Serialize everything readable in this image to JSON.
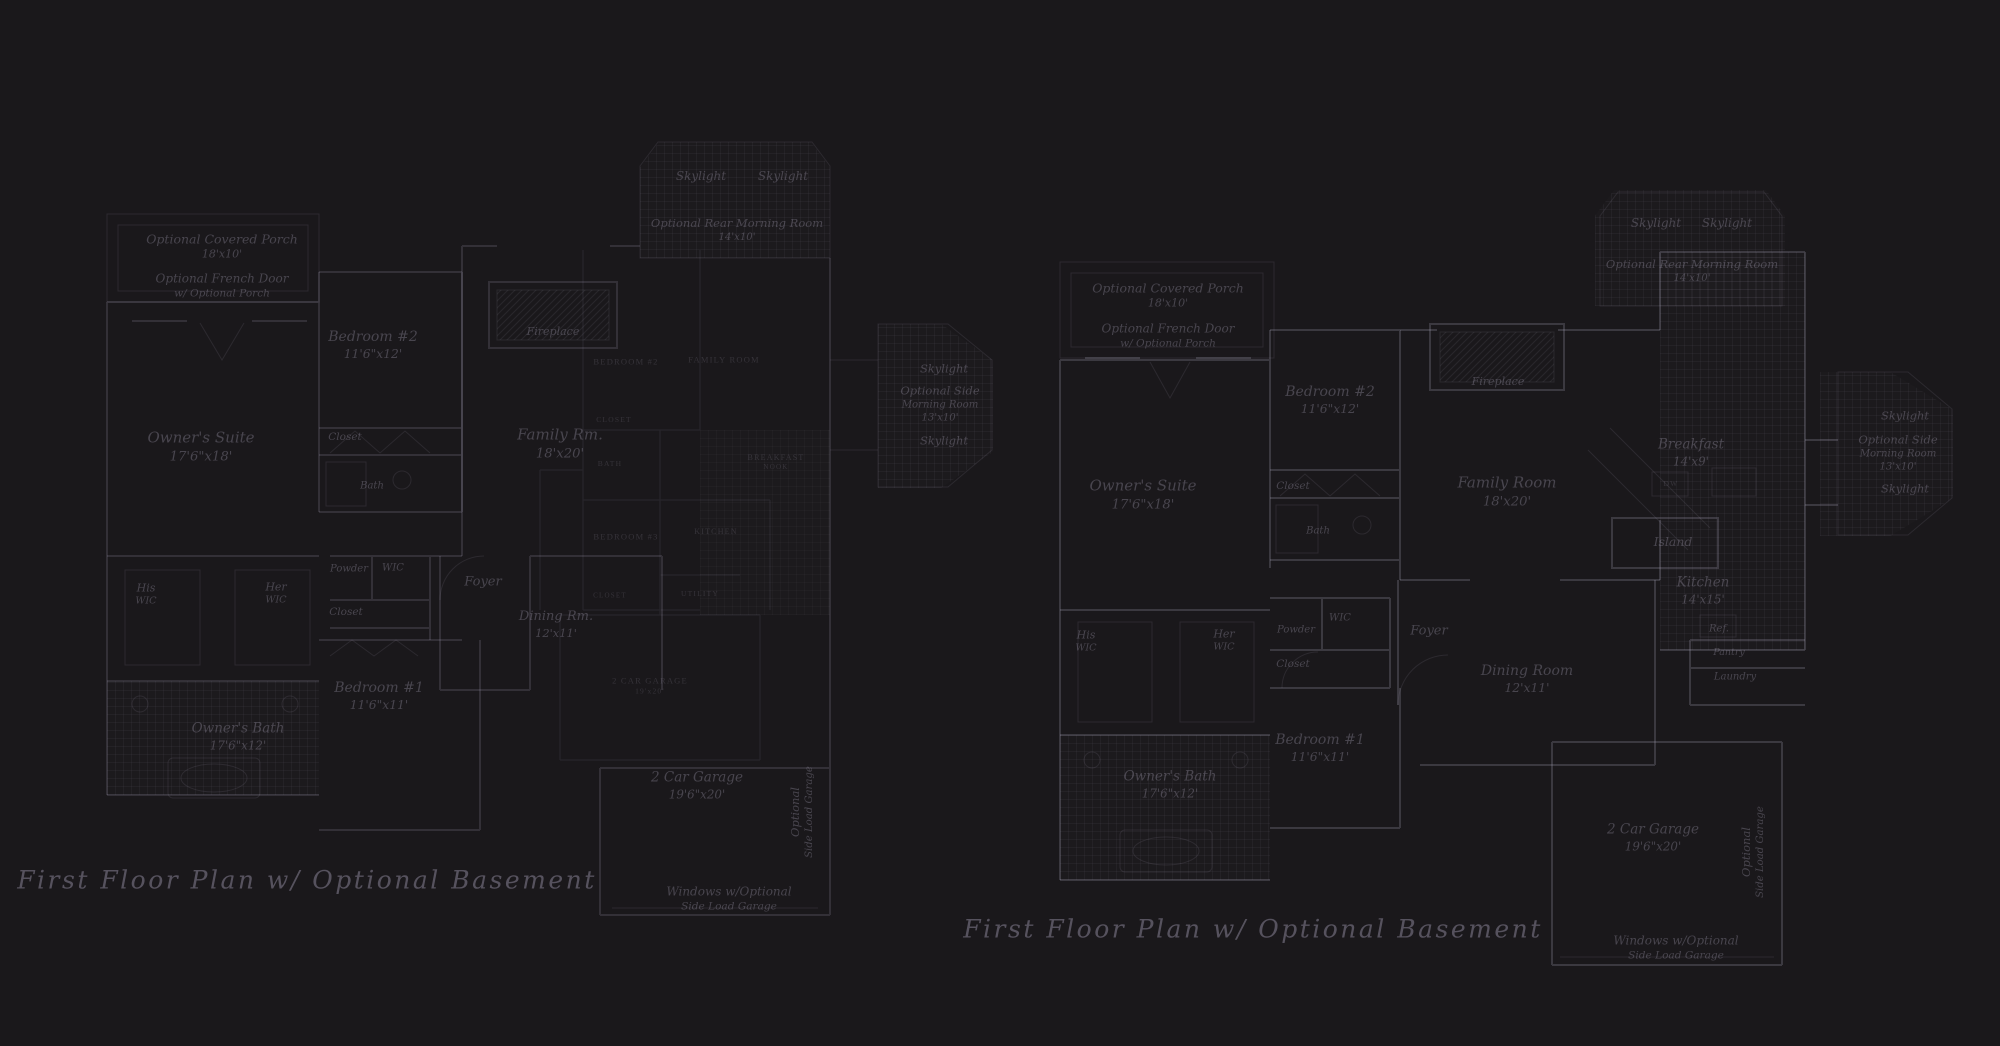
{
  "colors": {
    "background": "#1a181b",
    "wall_line": "#3b3843",
    "room_label_text": "#575263",
    "caption_text": "#5c5668"
  },
  "plans": [
    {
      "id": "left",
      "caption": "First Floor Plan  w/ Optional Basement",
      "caption_x": 307,
      "caption_y": 880,
      "labels": [
        {
          "name": "covered-porch-label",
          "x": 222,
          "y": 247,
          "size": 12.5,
          "lines": [
            "Optional Covered Porch",
            "18'x10'"
          ]
        },
        {
          "name": "french-door-label",
          "x": 222,
          "y": 286,
          "size": 12,
          "lines": [
            "Optional French Door",
            "w/ Optional Porch"
          ]
        },
        {
          "name": "skylight-rear-label-a",
          "x": 701,
          "y": 177,
          "size": 12,
          "lines": [
            "Skylight"
          ]
        },
        {
          "name": "skylight-rear-label-b",
          "x": 783,
          "y": 177,
          "size": 12,
          "lines": [
            "Skylight"
          ]
        },
        {
          "name": "rear-morning-room-label",
          "x": 737,
          "y": 230,
          "size": 11.5,
          "lines": [
            "Optional Rear Morning Room",
            "14'x10'"
          ]
        },
        {
          "name": "bedroom2-label",
          "x": 373,
          "y": 345,
          "size": 14,
          "lines": [
            "Bedroom #2",
            "11'6\"x12'"
          ]
        },
        {
          "name": "owners-suite-label",
          "x": 201,
          "y": 447,
          "size": 15,
          "lines": [
            "Owner's Suite",
            "17'6\"x18'"
          ]
        },
        {
          "name": "closet-bedroom2-label",
          "x": 345,
          "y": 438,
          "size": 10.5,
          "lines": [
            "Closet"
          ]
        },
        {
          "name": "bath-label",
          "x": 372,
          "y": 486,
          "size": 10,
          "lines": [
            "Bath"
          ]
        },
        {
          "name": "fireplace-label",
          "x": 553,
          "y": 332,
          "size": 11,
          "lines": [
            "Fireplace"
          ]
        },
        {
          "name": "family-rm-label",
          "x": 560,
          "y": 444,
          "size": 15,
          "lines": [
            "Family Rm.",
            "18'x20'"
          ]
        },
        {
          "name": "his-wic-label",
          "x": 146,
          "y": 595,
          "size": 11,
          "lines": [
            "His",
            "WIC"
          ]
        },
        {
          "name": "her-wic-label",
          "x": 276,
          "y": 594,
          "size": 11,
          "lines": [
            "Her",
            "WIC"
          ]
        },
        {
          "name": "powder-label",
          "x": 349,
          "y": 569,
          "size": 10,
          "lines": [
            "Powder"
          ]
        },
        {
          "name": "wic-label",
          "x": 393,
          "y": 568,
          "size": 10,
          "lines": [
            "WIC"
          ]
        },
        {
          "name": "closet-hall-label",
          "x": 346,
          "y": 613,
          "size": 10.5,
          "lines": [
            "Closet"
          ]
        },
        {
          "name": "foyer-label",
          "x": 483,
          "y": 583,
          "size": 13,
          "lines": [
            "Foyer"
          ]
        },
        {
          "name": "dining-label",
          "x": 556,
          "y": 625,
          "size": 13,
          "lines": [
            "Dining Rm.",
            "12'x11'"
          ]
        },
        {
          "name": "bedroom1-label",
          "x": 379,
          "y": 696,
          "size": 14,
          "lines": [
            "Bedroom #1",
            "11'6\"x11'"
          ]
        },
        {
          "name": "owners-bath-label",
          "x": 238,
          "y": 737,
          "size": 13.5,
          "lines": [
            "Owner's Bath",
            "17'6\"x12'"
          ]
        },
        {
          "name": "skylight-side-label-a",
          "x": 944,
          "y": 369,
          "size": 11.5,
          "lines": [
            "Skylight"
          ]
        },
        {
          "name": "side-morning-room-label",
          "x": 940,
          "y": 404,
          "size": 11.5,
          "lines": [
            "Optional Side",
            "Morning Room",
            "13'x10'"
          ]
        },
        {
          "name": "skylight-side-label-b",
          "x": 944,
          "y": 441,
          "size": 11.5,
          "lines": [
            "Skylight"
          ]
        },
        {
          "name": "garage-label",
          "x": 697,
          "y": 786,
          "size": 13.5,
          "lines": [
            "2 Car Garage",
            "19'6\"x20'"
          ]
        },
        {
          "name": "side-load-garage-label",
          "x": 802,
          "y": 812,
          "size": 11.5,
          "rotate": -90,
          "lines": [
            "Optional",
            "Side Load Garage"
          ]
        },
        {
          "name": "windows-note-label",
          "x": 729,
          "y": 899,
          "size": 12,
          "lines": [
            "Windows w/Optional",
            "Side Load Garage"
          ]
        },
        {
          "name": "overlay-bedroom2-label",
          "x": 626,
          "y": 362,
          "size": 8.5,
          "style": "caps",
          "lines": [
            "BEDROOM #2"
          ]
        },
        {
          "name": "overlay-family-room-label",
          "x": 724,
          "y": 360,
          "size": 8.5,
          "style": "caps",
          "lines": [
            "FAMILY ROOM"
          ]
        },
        {
          "name": "overlay-closet-label-a",
          "x": 614,
          "y": 420,
          "size": 7.5,
          "style": "caps",
          "lines": [
            "CLOSET"
          ]
        },
        {
          "name": "overlay-bath-label",
          "x": 610,
          "y": 464,
          "size": 7.5,
          "style": "caps",
          "lines": [
            "BATH"
          ]
        },
        {
          "name": "overlay-breakfast-nook-label",
          "x": 776,
          "y": 463,
          "size": 8,
          "style": "caps",
          "lines": [
            "BREAKFAST",
            "NOOK"
          ]
        },
        {
          "name": "overlay-kitchen-label",
          "x": 716,
          "y": 532,
          "size": 8,
          "style": "caps",
          "lines": [
            "KITCHEN"
          ]
        },
        {
          "name": "overlay-bedroom3-label",
          "x": 626,
          "y": 537,
          "size": 8.5,
          "style": "caps",
          "lines": [
            "BEDROOM #3"
          ]
        },
        {
          "name": "overlay-utility-label",
          "x": 700,
          "y": 594,
          "size": 7.5,
          "style": "caps",
          "lines": [
            "UTILITY"
          ]
        },
        {
          "name": "overlay-closet-label-b",
          "x": 610,
          "y": 596,
          "size": 7,
          "style": "caps",
          "lines": [
            "CLOSET"
          ]
        },
        {
          "name": "overlay-garage-label",
          "x": 650,
          "y": 686,
          "size": 8.5,
          "style": "caps",
          "lines": [
            "2 CAR GARAGE",
            "19'x20'"
          ]
        }
      ]
    },
    {
      "id": "right",
      "caption": "First Floor Plan  w/ Optional Basement",
      "caption_x": 1253,
      "caption_y": 929,
      "labels": [
        {
          "name": "covered-porch-label",
          "x": 1168,
          "y": 296,
          "size": 12.5,
          "lines": [
            "Optional Covered Porch",
            "18'x10'"
          ]
        },
        {
          "name": "french-door-label",
          "x": 1168,
          "y": 336,
          "size": 12,
          "lines": [
            "Optional French Door",
            "w/ Optional Porch"
          ]
        },
        {
          "name": "skylight-rear-label-a",
          "x": 1656,
          "y": 224,
          "size": 12,
          "lines": [
            "Skylight"
          ]
        },
        {
          "name": "skylight-rear-label-b",
          "x": 1727,
          "y": 224,
          "size": 12,
          "lines": [
            "Skylight"
          ]
        },
        {
          "name": "rear-morning-room-label",
          "x": 1692,
          "y": 271,
          "size": 11.5,
          "lines": [
            "Optional Rear Morning Room",
            "14'x10'"
          ]
        },
        {
          "name": "bedroom2-label",
          "x": 1330,
          "y": 400,
          "size": 14,
          "lines": [
            "Bedroom #2",
            "11'6\"x12'"
          ]
        },
        {
          "name": "owners-suite-label",
          "x": 1143,
          "y": 495,
          "size": 15,
          "lines": [
            "Owner's Suite",
            "17'6\"x18'"
          ]
        },
        {
          "name": "closet-bedroom2-label",
          "x": 1293,
          "y": 487,
          "size": 10.5,
          "lines": [
            "Closet"
          ]
        },
        {
          "name": "bath-label",
          "x": 1318,
          "y": 531,
          "size": 10,
          "lines": [
            "Bath"
          ]
        },
        {
          "name": "fireplace-label",
          "x": 1498,
          "y": 382,
          "size": 11,
          "lines": [
            "Fireplace"
          ]
        },
        {
          "name": "family-room-label",
          "x": 1507,
          "y": 492,
          "size": 15,
          "lines": [
            "Family Room",
            "18'x20'"
          ]
        },
        {
          "name": "breakfast-label",
          "x": 1691,
          "y": 453,
          "size": 13.5,
          "lines": [
            "Breakfast",
            "14'x9'"
          ]
        },
        {
          "name": "dw-label",
          "x": 1671,
          "y": 484,
          "size": 7.5,
          "style": "caps",
          "lines": [
            "DW"
          ]
        },
        {
          "name": "island-label",
          "x": 1673,
          "y": 542,
          "size": 12.5,
          "lines": [
            "Island"
          ]
        },
        {
          "name": "kitchen-label",
          "x": 1703,
          "y": 591,
          "size": 13.5,
          "lines": [
            "Kitchen",
            "14'x15'"
          ]
        },
        {
          "name": "ref-label",
          "x": 1719,
          "y": 629,
          "size": 10,
          "lines": [
            "Ref."
          ]
        },
        {
          "name": "pantry-label",
          "x": 1729,
          "y": 653,
          "size": 9.5,
          "lines": [
            "Pantry"
          ]
        },
        {
          "name": "laundry-label",
          "x": 1735,
          "y": 677,
          "size": 10,
          "lines": [
            "Laundry"
          ]
        },
        {
          "name": "his-wic-label",
          "x": 1086,
          "y": 642,
          "size": 11,
          "lines": [
            "His",
            "WIC"
          ]
        },
        {
          "name": "her-wic-label",
          "x": 1224,
          "y": 641,
          "size": 11,
          "lines": [
            "Her",
            "WIC"
          ]
        },
        {
          "name": "powder-label",
          "x": 1296,
          "y": 630,
          "size": 10,
          "lines": [
            "Powder"
          ]
        },
        {
          "name": "wic-label",
          "x": 1340,
          "y": 618,
          "size": 10,
          "lines": [
            "WIC"
          ]
        },
        {
          "name": "closet-hall-label",
          "x": 1293,
          "y": 665,
          "size": 10.5,
          "lines": [
            "Closet"
          ]
        },
        {
          "name": "foyer-label",
          "x": 1429,
          "y": 632,
          "size": 13,
          "lines": [
            "Foyer"
          ]
        },
        {
          "name": "dining-room-label",
          "x": 1527,
          "y": 679,
          "size": 14,
          "lines": [
            "Dining Room",
            "12'x11'"
          ]
        },
        {
          "name": "bedroom1-label",
          "x": 1320,
          "y": 748,
          "size": 14,
          "lines": [
            "Bedroom #1",
            "11'6\"x11'"
          ]
        },
        {
          "name": "owners-bath-label",
          "x": 1170,
          "y": 785,
          "size": 13.5,
          "lines": [
            "Owner's Bath",
            "17'6\"x12'"
          ]
        },
        {
          "name": "skylight-side-label-a",
          "x": 1905,
          "y": 416,
          "size": 11.5,
          "lines": [
            "Skylight"
          ]
        },
        {
          "name": "side-morning-room-label",
          "x": 1898,
          "y": 453,
          "size": 11.5,
          "lines": [
            "Optional Side",
            "Morning Room",
            "13'x10'"
          ]
        },
        {
          "name": "skylight-side-label-b",
          "x": 1905,
          "y": 489,
          "size": 11.5,
          "lines": [
            "Skylight"
          ]
        },
        {
          "name": "garage-label",
          "x": 1653,
          "y": 838,
          "size": 13.5,
          "lines": [
            "2 Car Garage",
            "19'6\"x20'"
          ]
        },
        {
          "name": "side-load-garage-label",
          "x": 1753,
          "y": 852,
          "size": 11.5,
          "rotate": -90,
          "lines": [
            "Optional",
            "Side Load Garage"
          ]
        },
        {
          "name": "windows-note-label",
          "x": 1676,
          "y": 948,
          "size": 12,
          "lines": [
            "Windows w/Optional",
            "Side Load Garage"
          ]
        }
      ]
    }
  ]
}
